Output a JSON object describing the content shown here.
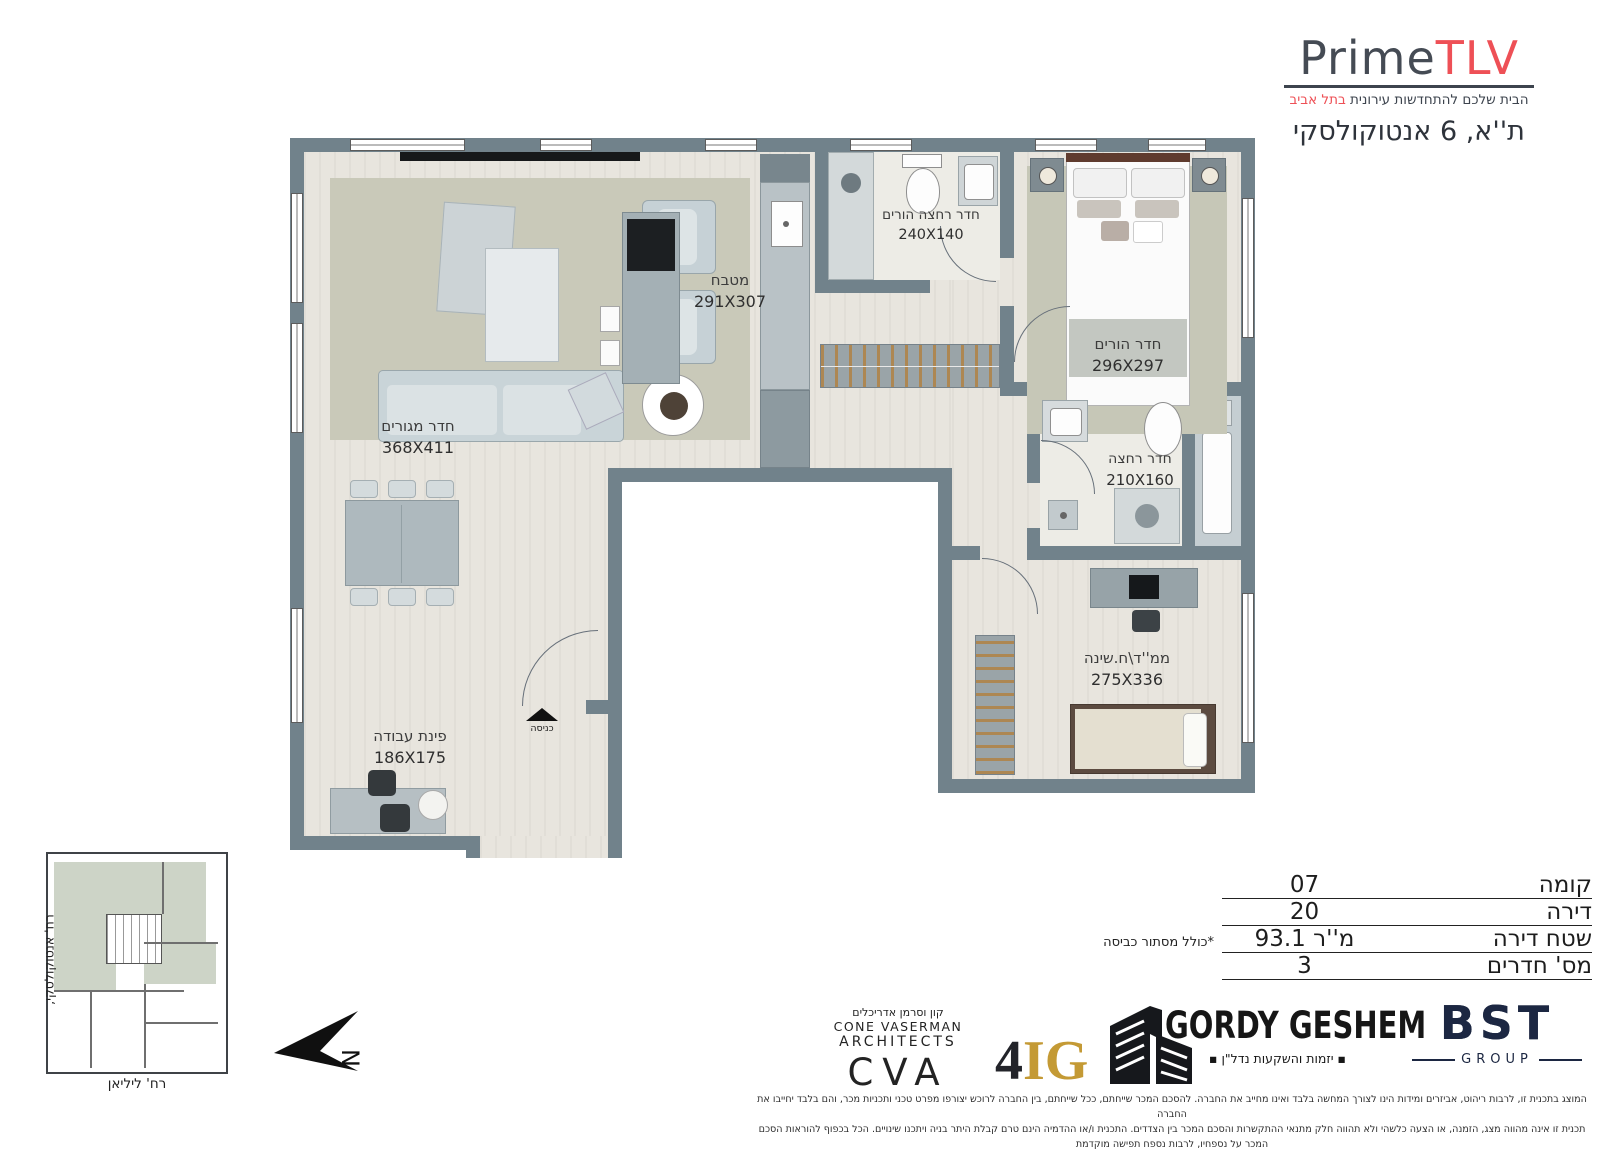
{
  "brand": {
    "prime": "Prime",
    "tlv": "TLV",
    "tagline_main": "הבית שלכם להתחדשות עירונית ",
    "tagline_accent": "בתל אביב",
    "address": "ת''א, 6 אנטוקולסקי",
    "accent_color": "#ee5056",
    "dark_color": "#3d444e"
  },
  "plan": {
    "rooms": [
      {
        "name": "מטבח",
        "dims": "291X307"
      },
      {
        "name": "חדר רחצה הורים",
        "dims": "240X140"
      },
      {
        "name": "חדר הורים",
        "dims": "296X297"
      },
      {
        "name": "חדר מגורים",
        "dims": "368X411"
      },
      {
        "name": "חדר רחצה",
        "dims": "210X160"
      },
      {
        "name": "ממ''ד\\ח.שינה",
        "dims": "275X336"
      },
      {
        "name": "פינת עבודה",
        "dims": "186X175"
      }
    ],
    "entrance_label": "כניסה",
    "north_label": "N"
  },
  "keyplan": {
    "street_bottom": "רח' ליליאן",
    "street_side": "רח' אנטוקולסקי,"
  },
  "info_table": {
    "rows": [
      {
        "label": "קומה",
        "value": "07"
      },
      {
        "label": "דירה",
        "value": "20"
      },
      {
        "label": "שטח דירה",
        "value": "93.1 מ''ר"
      },
      {
        "label": "מס' חדרים",
        "value": "3"
      }
    ],
    "note": "*כולל מסתור כביסה"
  },
  "logos": {
    "cva": {
      "hebrew": "קון וסרמן אדריכלים",
      "line1": "CONE  VASERMAN",
      "line2": "ARCHITECTS",
      "big": "CVA"
    },
    "fig": {
      "num": "4",
      "ig": "IG",
      "gold": "#c49a35"
    },
    "gordy": {
      "name": "GORDY GESHEM",
      "sub": "▪ יזמות והשקעות נדל\"ן ▪"
    },
    "bst": {
      "name": "BST",
      "sub": "GROUP",
      "navy": "#1c2742"
    }
  },
  "legal": {
    "line1": "המוצג בתכנית זו, לרבות ריהוט, אביזרים ומידות הינו לצורך המחשה בלבד ואינו מחייב את החברה. להסכם המכר שייחתם, ככל שייחתם, בין החברה לרוכש יצורפו מפרט טכני ותכניות מכר, והם בלבד יחייבו את החברה",
    "line2": "תכנית זו אינה מהווה מצג, הזמנה, או הצעה כלשהי ולא תהווה חלק מתנאי ההתקשרות והסכם המכר בין הצדדים. התכנית ו/או ההדמיה הינם טרם קבלת היתר בניה ויתכנו שינויים. הכל בכפוף להוראות הסכם המכר על נספחיו, לרבות נספח תפישה מוקדמת"
  }
}
